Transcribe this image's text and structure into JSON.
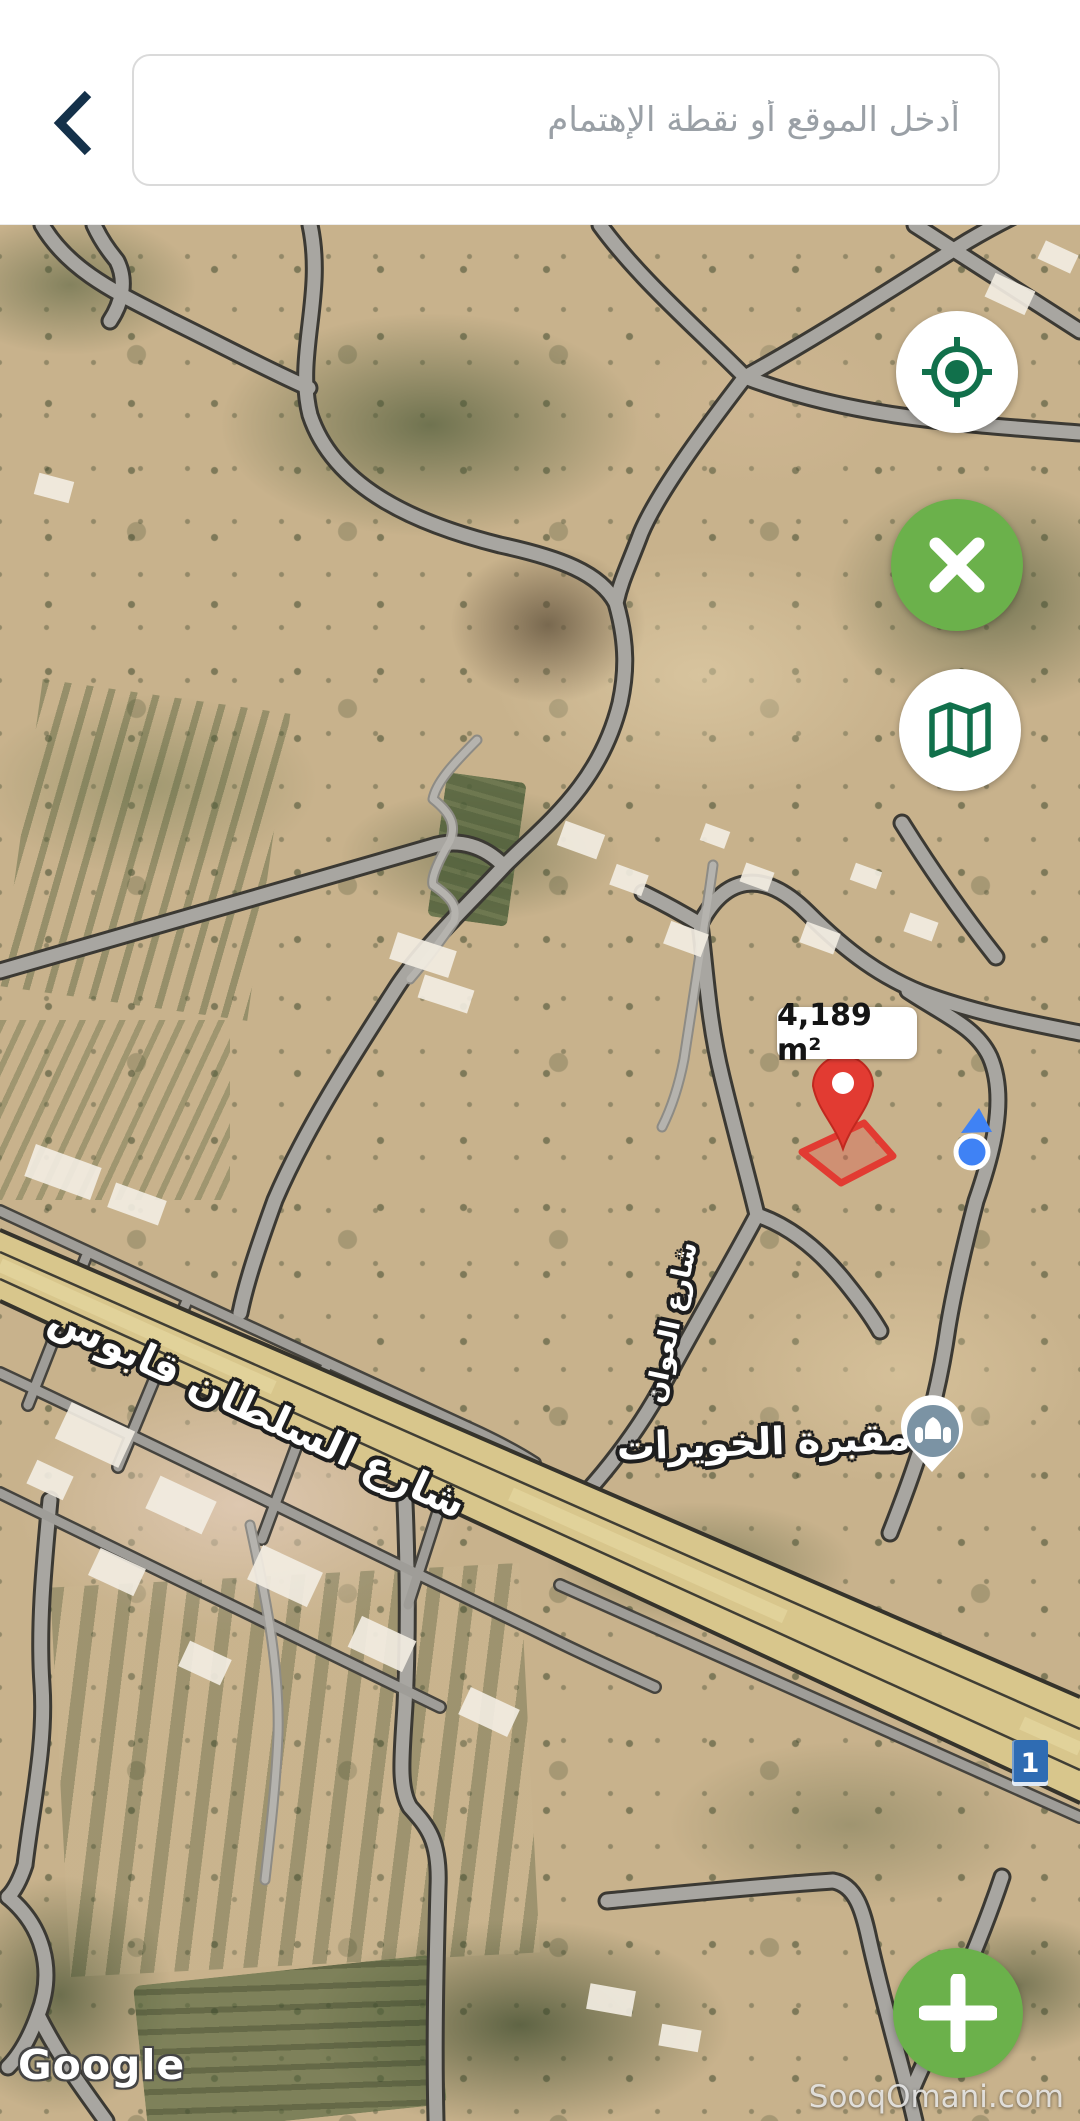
{
  "header": {
    "back_icon": "chevron-left-icon",
    "search_placeholder": "أدخل الموقع أو نقطة الإهتمام"
  },
  "map": {
    "view": "satellite",
    "area_label": "4,189 m²",
    "route_shield": "1",
    "labels": {
      "highway": "شارع السلطان قابوس",
      "road_awan": "شارع العوان",
      "cemetery": "مقبرة الخويرات"
    },
    "attribution": "Google",
    "watermark": "SooqOmani.com",
    "markers": {
      "selected_parcel_pin": "red-pin-icon",
      "current_location": "blue-dot-icon",
      "cemetery_poi": "cemetery-icon"
    }
  },
  "controls": {
    "locate_icon": "my-location-icon",
    "clear_icon": "close-icon",
    "layers_icon": "map-layers-icon",
    "add_icon": "plus-icon"
  },
  "colors": {
    "accent_green": "#6bb14b",
    "icon_dark_green": "#11704b",
    "navy": "#14314a",
    "pin_red": "#e23b32",
    "location_blue": "#3f82f5",
    "poi_blue_gray": "#7b93a4",
    "shield_blue": "#2f6cb3",
    "highway_tan": "#d8c68c"
  }
}
